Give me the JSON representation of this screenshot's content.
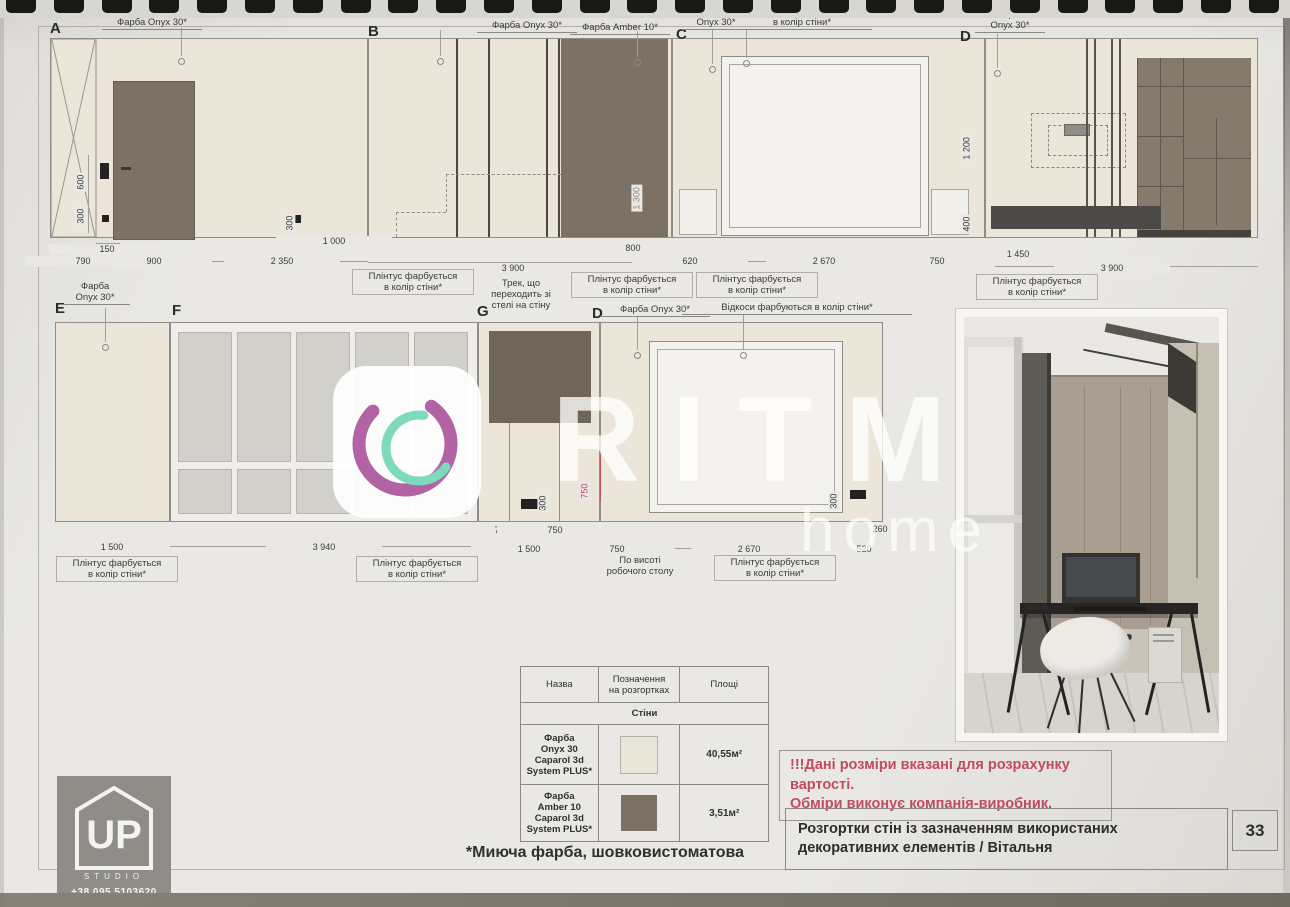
{
  "colors": {
    "paper": "#e9e8e4",
    "cream": "#ebe6d9",
    "amber": "#7b7164",
    "dark_bar": "#4b4a46",
    "pane": "#d1d0cb",
    "red": "#c24b5e",
    "ink": "#3a3a37",
    "line": "#8f8d86",
    "wm_pink": "#b163a3",
    "wm_teal": "#7ed9bd"
  },
  "watermark": {
    "brand": "RITM",
    "word": "home"
  },
  "logo": {
    "up": "UP",
    "studio": "STUDIO",
    "phone": "+38 095 5103620"
  },
  "titleblock": {
    "title": "Розгортки стін із зазначенням використаних декоративних елементів / Вітальня",
    "page_number": "33"
  },
  "warning": {
    "line1": "!!!Дані розміри вказані для розрахунку вартості.",
    "line2": "Обміри виконує компанія-виробник."
  },
  "footnote": "*Миюча фарба, шовковистоматова",
  "table": {
    "headers": [
      "Назва",
      "Позначення\nна розгортках",
      "Площі"
    ],
    "section": "Стіни",
    "rows": [
      {
        "name": "Фарба\nOnyx 30\nCaparol 3d\nSystem PLUS*",
        "swatch": "#e9e5d9",
        "area": "40,55м²"
      },
      {
        "name": "Фарба\nAmber 10\nCaparol 3d\nSystem PLUS*",
        "swatch": "#7b7164",
        "area": "3,51м²"
      }
    ]
  },
  "annotations": [
    {
      "t": "A",
      "x": 50,
      "y": 20,
      "kind": "letter"
    },
    {
      "t": "B",
      "x": 368,
      "y": 23,
      "kind": "letter"
    },
    {
      "t": "C",
      "x": 676,
      "y": 26,
      "kind": "letter"
    },
    {
      "t": "D",
      "x": 960,
      "y": 28,
      "kind": "letter"
    },
    {
      "t": "E",
      "x": 55,
      "y": 300,
      "kind": "letter"
    },
    {
      "t": "F",
      "x": 172,
      "y": 302,
      "kind": "letter"
    },
    {
      "t": "G",
      "x": 477,
      "y": 303,
      "kind": "letter"
    },
    {
      "t": "D",
      "x": 592,
      "y": 305,
      "kind": "letter"
    },
    {
      "t": "Фарба Onyx 30*",
      "x": 152,
      "y": 17,
      "w": 100,
      "kind": "paint"
    },
    {
      "t": "Фарба Onyx 30*",
      "x": 527,
      "y": 20,
      "w": 100,
      "kind": "paint"
    },
    {
      "t": "Фарба Amber 10*",
      "x": 620,
      "y": 22,
      "w": 100,
      "kind": "paint"
    },
    {
      "t": "Фарба\nOnyx 30*",
      "x": 716,
      "y": 6,
      "w": 70,
      "kind": "paint"
    },
    {
      "t": "Відкоси фарбуються\nв колір стіни*",
      "x": 802,
      "y": 6,
      "w": 140,
      "kind": "paint"
    },
    {
      "t": "Фарба\nOnyx 30*",
      "x": 1010,
      "y": 9,
      "w": 70,
      "kind": "paint"
    },
    {
      "t": "Фарба\nOnyx 30*",
      "x": 95,
      "y": 281,
      "w": 70,
      "kind": "paint"
    },
    {
      "t": "Фарба Onyx 30*",
      "x": 655,
      "y": 304,
      "w": 110,
      "kind": "paint"
    },
    {
      "t": "Відкоси фарбуються в колір стіни*",
      "x": 797,
      "y": 302,
      "w": 230,
      "kind": "paint"
    },
    {
      "t": "150",
      "x": 105,
      "y": 244,
      "kind": "dim"
    },
    {
      "t": "790",
      "x": 81,
      "y": 256,
      "kind": "dim"
    },
    {
      "t": "900",
      "x": 152,
      "y": 256,
      "kind": "dim"
    },
    {
      "t": "2 350",
      "x": 280,
      "y": 256,
      "kind": "dim"
    },
    {
      "t": "1 000",
      "x": 332,
      "y": 236,
      "kind": "dim"
    },
    {
      "t": "3 900",
      "x": 511,
      "y": 263,
      "kind": "dim"
    },
    {
      "t": "800",
      "x": 631,
      "y": 243,
      "kind": "dim"
    },
    {
      "t": "620",
      "x": 688,
      "y": 256,
      "kind": "dim"
    },
    {
      "t": "2 670",
      "x": 822,
      "y": 256,
      "kind": "dim"
    },
    {
      "t": "750",
      "x": 935,
      "y": 256,
      "kind": "dim"
    },
    {
      "t": "1 450",
      "x": 1016,
      "y": 249,
      "kind": "dim"
    },
    {
      "t": "3 900",
      "x": 1110,
      "y": 263,
      "kind": "dim"
    },
    {
      "t": "750",
      "x": 500,
      "y": 525,
      "kind": "dim"
    },
    {
      "t": "750",
      "x": 553,
      "y": 525,
      "kind": "dim"
    },
    {
      "t": "1 500",
      "x": 527,
      "y": 544,
      "kind": "dim"
    },
    {
      "t": "1 500",
      "x": 110,
      "y": 542,
      "kind": "dim"
    },
    {
      "t": "3 940",
      "x": 322,
      "y": 542,
      "kind": "dim"
    },
    {
      "t": "750",
      "x": 615,
      "y": 544,
      "kind": "dim"
    },
    {
      "t": "2 670",
      "x": 747,
      "y": 544,
      "kind": "dim"
    },
    {
      "t": "260",
      "x": 855,
      "y": 524,
      "kind": "dim"
    },
    {
      "t": "260",
      "x": 878,
      "y": 524,
      "kind": "dim"
    },
    {
      "t": "520",
      "x": 862,
      "y": 544,
      "kind": "dim"
    },
    {
      "t": "600",
      "x": 86,
      "y": 192,
      "kind": "vdim"
    },
    {
      "t": "300",
      "x": 86,
      "y": 226,
      "kind": "vdim"
    },
    {
      "t": "300",
      "x": 295,
      "y": 233,
      "kind": "vdim"
    },
    {
      "t": "1 300",
      "x": 642,
      "y": 212,
      "kind": "vdim",
      "c": "faint"
    },
    {
      "t": "1 200",
      "x": 972,
      "y": 162,
      "kind": "vdim"
    },
    {
      "t": "400",
      "x": 972,
      "y": 234,
      "kind": "vdim"
    },
    {
      "t": "300",
      "x": 548,
      "y": 513,
      "kind": "vdim"
    },
    {
      "t": "750",
      "x": 590,
      "y": 501,
      "kind": "vdim",
      "c": "red"
    },
    {
      "t": "300",
      "x": 839,
      "y": 511,
      "kind": "vdim"
    },
    {
      "t": "Плінтус фарбується\nв колір стіни*",
      "x": 408,
      "y": 269,
      "kind": "callout"
    },
    {
      "t": "Плінтус фарбується\nв колір стіни*",
      "x": 627,
      "y": 272,
      "kind": "callout"
    },
    {
      "t": "Плінтус фарбується\nв колір стіни*",
      "x": 752,
      "y": 272,
      "kind": "callout"
    },
    {
      "t": "Плінтус фарбується\nв колір стіни*",
      "x": 1032,
      "y": 274,
      "kind": "callout"
    },
    {
      "t": "Трек, що\nпереходить зі\nстелі на стіну",
      "x": 521,
      "y": 278,
      "kind": "note"
    },
    {
      "t": "Плінтус фарбується\nв колір стіни*",
      "x": 112,
      "y": 556,
      "kind": "callout"
    },
    {
      "t": "Плінтус фарбується\nв колір стіни*",
      "x": 412,
      "y": 556,
      "kind": "callout"
    },
    {
      "t": "По висоті\nробочого столу",
      "x": 640,
      "y": 555,
      "kind": "note"
    },
    {
      "t": "Плінтус фарбується\nв колір стіни*",
      "x": 770,
      "y": 555,
      "kind": "callout"
    }
  ]
}
